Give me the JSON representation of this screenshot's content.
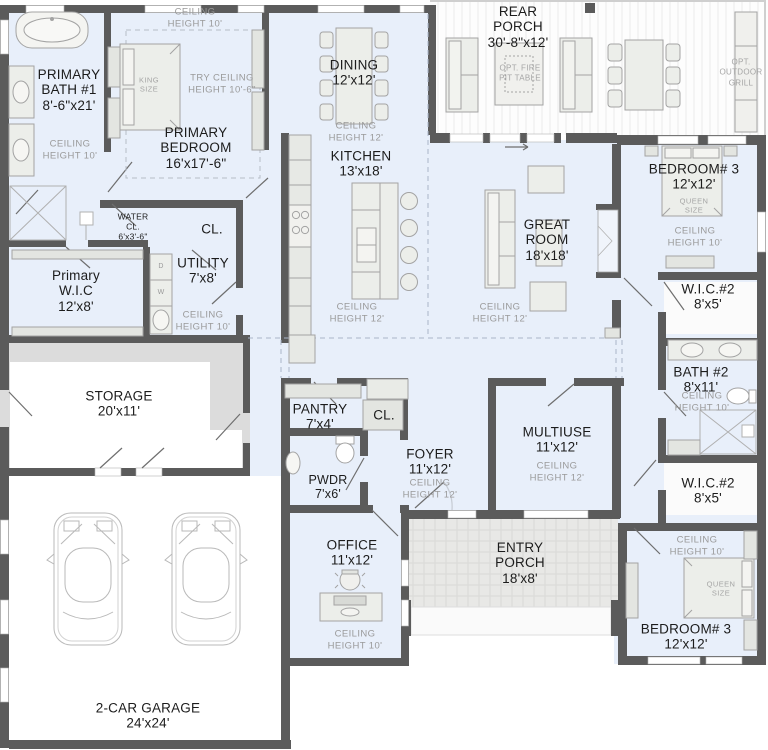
{
  "colors": {
    "floor": "#e8effa",
    "wall": "#5b5b5b",
    "furniture_fill": "#eceeea",
    "furniture_stroke": "#a3a3a3",
    "rear_porch_floor": "#fdfdfd",
    "entry_porch_floor": "#e8e8e6",
    "storage_band": "#dcdcdc",
    "garage_floor": "#ffffff",
    "text": "#1c1c1c",
    "muted_text": "#9a9a9a",
    "dashed_line": "#aab4c8"
  },
  "rooms": {
    "primary_bath": {
      "name": "PRIMARY BATH #1",
      "dims": "8'-6\"x21'",
      "ceiling": "CEILING HEIGHT 10'"
    },
    "primary_bedroom": {
      "name": "PRIMARY BEDROOM",
      "dims": "16'x17'-6\"",
      "ceiling": "CEILING HEIGHT 10'",
      "tray": "TRY CEILING HEIGHT 10'-6\"",
      "bed": "KING SIZE"
    },
    "dining": {
      "name": "DINING",
      "dims": "12'x12'",
      "ceiling": "CEILING HEIGHT 12'"
    },
    "kitchen": {
      "name": "KITCHEN",
      "dims": "13'x18'",
      "ceiling": "CEILING HEIGHT 12'"
    },
    "rear_porch": {
      "name": "REAR PORCH",
      "dims": "30'-8\"x12'",
      "fire_pit": "OPT. FIRE PIT TABLE",
      "grill": "OPT. OUTDOOR GRILL"
    },
    "great_room": {
      "name": "GREAT ROOM",
      "dims": "18'x18'",
      "ceiling": "CEILING HEIGHT 12'"
    },
    "bedroom3_top": {
      "name": "BEDROOM# 3",
      "dims": "12'x12'",
      "bed": "QUEEN SIZE",
      "ceiling": "CEILING HEIGHT 10'"
    },
    "wic2_top": {
      "name": "W.I.C.#2",
      "dims": "8'x5'"
    },
    "bath2": {
      "name": "BATH #2",
      "dims": "8'x11'",
      "ceiling": "CEILING HEIGHT 10'"
    },
    "wic2_bottom": {
      "name": "W.I.C.#2",
      "dims": "8'x5'"
    },
    "bedroom3_bottom": {
      "name": "BEDROOM# 3",
      "dims": "12'x12'",
      "bed": "QUEEN SIZE",
      "ceiling": "CEILING HEIGHT 10'"
    },
    "water_closet": {
      "name": "WATER CL.",
      "dims": "6'x3'-6\""
    },
    "closet_hall": {
      "name": "CL."
    },
    "primary_wic": {
      "name": "Primary W.I.C",
      "dims": "12'x8'"
    },
    "utility": {
      "name": "UTILITY",
      "dims": "7'x8'",
      "ceiling": "CEILING HEIGHT 10'",
      "dryer": "D",
      "washer": "W"
    },
    "storage": {
      "name": "STORAGE",
      "dims": "20'x11'"
    },
    "pantry": {
      "name": "PANTRY",
      "dims": "7'x4'"
    },
    "closet_foyer": {
      "name": "CL."
    },
    "foyer": {
      "name": "FOYER",
      "dims": "11'x12'",
      "ceiling": "CEILING HEIGHT 12'"
    },
    "pwdr": {
      "name": "PWDR",
      "dims": "7'x6'"
    },
    "office": {
      "name": "OFFICE",
      "dims": "11'x12'",
      "ceiling": "CEILING HEIGHT 10'"
    },
    "multiuse": {
      "name": "MULTIUSE",
      "dims": "11'x12'",
      "ceiling": "CEILING HEIGHT 12'"
    },
    "entry_porch": {
      "name": "ENTRY PORCH",
      "dims": "18'x8'"
    },
    "garage": {
      "name": "2-CAR GARAGE",
      "dims": "24'x24'"
    }
  }
}
